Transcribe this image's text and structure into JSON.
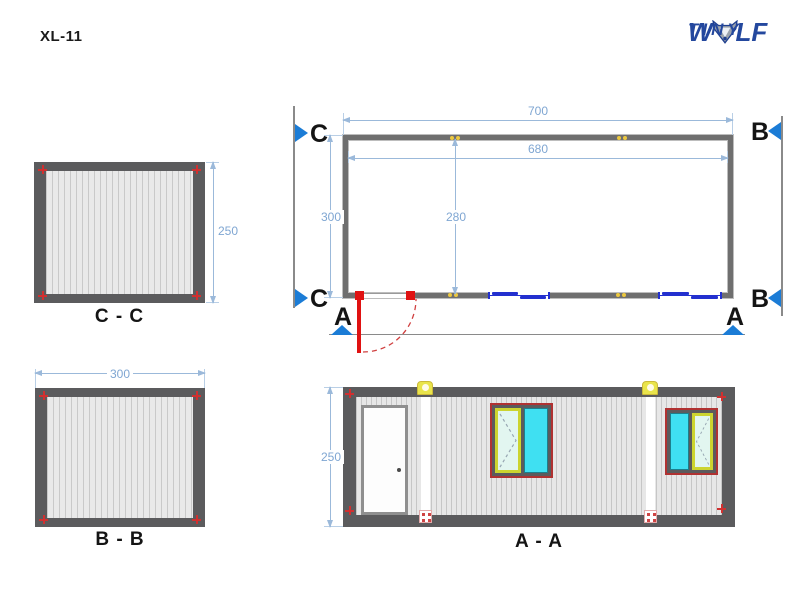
{
  "header": {
    "title": "XL-11",
    "logo": {
      "word_start": "W",
      "word_end": "LF",
      "subtitle": "TINY"
    }
  },
  "floor_plan": {
    "dims": {
      "outer_width": "700",
      "inner_width": "680",
      "outer_depth": "300",
      "inner_depth": "280"
    },
    "markers": {
      "c": "C",
      "b": "B",
      "a": "A"
    }
  },
  "sections": {
    "cc": {
      "label": "C - C",
      "dim_height": "250"
    },
    "bb": {
      "label": "B - B",
      "dim_width": "300"
    },
    "aa": {
      "label": "A - A",
      "dim_height": "250"
    }
  },
  "colors": {
    "brand_navy": "#24489e",
    "marker_blue": "#1b7cd6",
    "dimension_blue": "#7fa6d2",
    "frame_gray": "#5b5b5d",
    "door_red": "#e01212",
    "window_cyan": "#3fe0f2",
    "sash_green": "#ccd42f",
    "joint_yellow": "#e9e44b",
    "plan_window_blue": "#2330cf"
  }
}
